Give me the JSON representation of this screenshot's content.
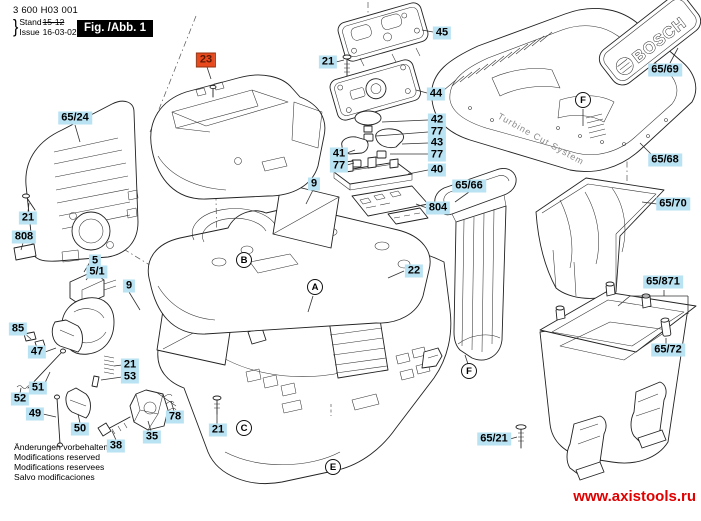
{
  "header": {
    "part_number": "3 600 H03 001",
    "stand_label": "Stand",
    "issue_label": "Issue",
    "brace": "}",
    "old_date": "15-12",
    "date": "16-03-02",
    "figure_label": "Fig. /Abb. 1"
  },
  "logo": {
    "brand": "BOSCH",
    "tagline": "Turbine Cut System"
  },
  "diagram": {
    "callouts": [
      {
        "label": "65/24",
        "x": 75,
        "y": 118,
        "selected": false
      },
      {
        "label": "21",
        "x": 28,
        "y": 218,
        "selected": false
      },
      {
        "label": "808",
        "x": 24,
        "y": 237,
        "selected": false
      },
      {
        "label": "5",
        "x": 95,
        "y": 261,
        "selected": false
      },
      {
        "label": "5/1",
        "x": 97,
        "y": 272,
        "selected": false
      },
      {
        "label": "9",
        "x": 129,
        "y": 286,
        "selected": false
      },
      {
        "label": "85",
        "x": 18,
        "y": 329,
        "selected": false
      },
      {
        "label": "47",
        "x": 37,
        "y": 352,
        "selected": false
      },
      {
        "label": "21",
        "x": 130,
        "y": 365,
        "selected": false
      },
      {
        "label": "53",
        "x": 130,
        "y": 377,
        "selected": false
      },
      {
        "label": "51",
        "x": 38,
        "y": 388,
        "selected": false
      },
      {
        "label": "52",
        "x": 20,
        "y": 399,
        "selected": false
      },
      {
        "label": "49",
        "x": 35,
        "y": 414,
        "selected": false
      },
      {
        "label": "50",
        "x": 80,
        "y": 429,
        "selected": false
      },
      {
        "label": "38",
        "x": 116,
        "y": 446,
        "selected": false
      },
      {
        "label": "35",
        "x": 152,
        "y": 437,
        "selected": false
      },
      {
        "label": "78",
        "x": 175,
        "y": 417,
        "selected": false
      },
      {
        "label": "21",
        "x": 218,
        "y": 430,
        "selected": false
      },
      {
        "label": "23",
        "x": 206,
        "y": 60,
        "selected": true
      },
      {
        "label": "21",
        "x": 328,
        "y": 62,
        "selected": false
      },
      {
        "label": "45",
        "x": 442,
        "y": 33,
        "selected": false
      },
      {
        "label": "44",
        "x": 436,
        "y": 94,
        "selected": false
      },
      {
        "label": "42",
        "x": 437,
        "y": 120,
        "selected": false
      },
      {
        "label": "77",
        "x": 437,
        "y": 132,
        "selected": false
      },
      {
        "label": "43",
        "x": 437,
        "y": 143,
        "selected": false
      },
      {
        "label": "77",
        "x": 437,
        "y": 155,
        "selected": false
      },
      {
        "label": "41",
        "x": 339,
        "y": 154,
        "selected": false
      },
      {
        "label": "77",
        "x": 339,
        "y": 166,
        "selected": false
      },
      {
        "label": "40",
        "x": 437,
        "y": 170,
        "selected": false
      },
      {
        "label": "9",
        "x": 314,
        "y": 184,
        "selected": false
      },
      {
        "label": "804",
        "x": 438,
        "y": 208,
        "selected": false
      },
      {
        "label": "22",
        "x": 414,
        "y": 271,
        "selected": false
      },
      {
        "label": "65/66",
        "x": 469,
        "y": 186,
        "selected": false
      },
      {
        "label": "65/69",
        "x": 665,
        "y": 70,
        "selected": false
      },
      {
        "label": "65/68",
        "x": 665,
        "y": 160,
        "selected": false
      },
      {
        "label": "65/70",
        "x": 673,
        "y": 204,
        "selected": false
      },
      {
        "label": "65/871",
        "x": 663,
        "y": 282,
        "selected": false
      },
      {
        "label": "65/72",
        "x": 668,
        "y": 350,
        "selected": false
      },
      {
        "label": "65/21",
        "x": 494,
        "y": 439,
        "selected": false
      }
    ],
    "balloons": [
      {
        "letter": "A",
        "x": 315,
        "y": 287
      },
      {
        "letter": "B",
        "x": 244,
        "y": 260
      },
      {
        "letter": "C",
        "x": 244,
        "y": 428
      },
      {
        "letter": "E",
        "x": 333,
        "y": 467
      },
      {
        "letter": "F",
        "x": 583,
        "y": 100
      },
      {
        "letter": "F",
        "x": 469,
        "y": 371
      }
    ]
  },
  "footer": {
    "notes": [
      "Änderungen vorbehalten",
      "Modifications reserved",
      "Modifications reservees",
      "Salvo modificaciones"
    ],
    "website": "www.axistools.ru"
  },
  "colors": {
    "callout_bg": "#b9e2f2",
    "selected_bg": "#e8491d",
    "selected_text": "#5d1a05",
    "website": "#e10000"
  }
}
